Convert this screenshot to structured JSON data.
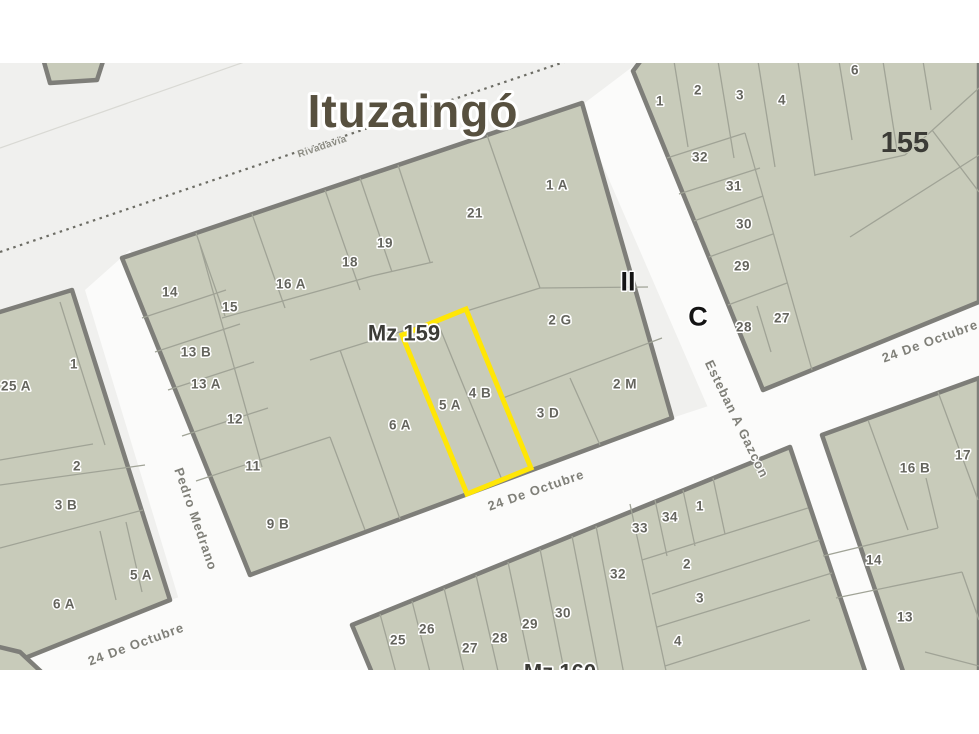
{
  "map": {
    "city_label": "Ituzaingó",
    "zone_markers": {
      "roman": "II",
      "letter": "C"
    },
    "colors": {
      "map_background": "#f0f0ee",
      "street_fill": "#fbfbfa",
      "parcel_fill": "#c8cbba",
      "block_border": "#7e7e79",
      "parcel_line": "#a0a396",
      "highlight": "#ffe606"
    },
    "streets": {
      "rivadavia": {
        "name": "Rivadavia"
      },
      "pedro_medrano": {
        "name": "Pedro Medrano"
      },
      "esteban_gazcon": {
        "name": "Esteban A Gazcon"
      },
      "octubre": {
        "name": "24 De Octubre"
      }
    },
    "blocks": {
      "mz159": {
        "name": "Mz 159",
        "parcels": [
          {
            "label": "1 A"
          },
          {
            "label": "21"
          },
          {
            "label": "19"
          },
          {
            "label": "18"
          },
          {
            "label": "16 A"
          },
          {
            "label": "14"
          },
          {
            "label": "15"
          },
          {
            "label": "13 B"
          },
          {
            "label": "13 A"
          },
          {
            "label": "12"
          },
          {
            "label": "11"
          },
          {
            "label": "9 B"
          },
          {
            "label": "2 G"
          },
          {
            "label": "2 M"
          },
          {
            "label": "3 D"
          },
          {
            "label": "4 B"
          },
          {
            "label": "5 A"
          },
          {
            "label": "6 A"
          }
        ],
        "selected_parcels": [
          "5 A",
          "4 B"
        ]
      },
      "b155": {
        "name": "155",
        "parcels": [
          {
            "label": "1"
          },
          {
            "label": "2"
          },
          {
            "label": "3"
          },
          {
            "label": "4"
          },
          {
            "label": "6"
          },
          {
            "label": "32"
          },
          {
            "label": "31"
          },
          {
            "label": "30"
          },
          {
            "label": "29"
          },
          {
            "label": "28"
          },
          {
            "label": "27"
          }
        ]
      },
      "mz160": {
        "name": "Mz 160",
        "parcels": [
          {
            "label": "25"
          },
          {
            "label": "26"
          },
          {
            "label": "27"
          },
          {
            "label": "28"
          },
          {
            "label": "29"
          },
          {
            "label": "30"
          },
          {
            "label": "32"
          },
          {
            "label": "33"
          },
          {
            "label": "34"
          },
          {
            "label": "1"
          },
          {
            "label": "2"
          },
          {
            "label": "3"
          },
          {
            "label": "4"
          }
        ]
      },
      "west": {
        "parcels": [
          {
            "label": "25 A"
          },
          {
            "label": "1"
          },
          {
            "label": "2"
          },
          {
            "label": "3 B"
          },
          {
            "label": "5 A"
          },
          {
            "label": "6 A"
          }
        ]
      },
      "southeast": {
        "parcels": [
          {
            "label": "16 B"
          },
          {
            "label": "17"
          },
          {
            "label": "14"
          },
          {
            "label": "13"
          }
        ]
      }
    }
  }
}
